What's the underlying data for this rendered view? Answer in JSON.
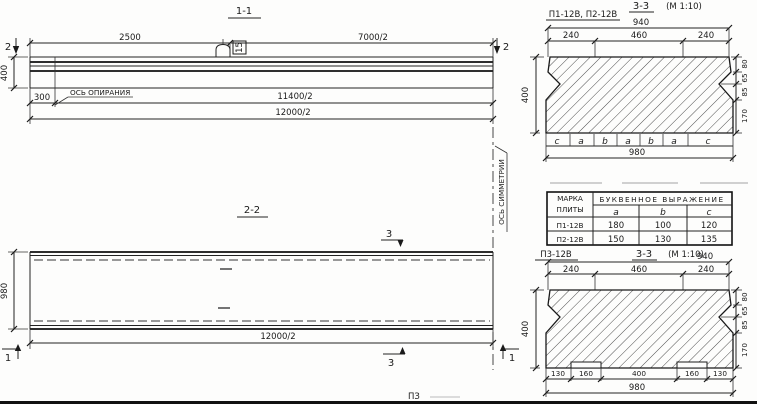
{
  "meta": {
    "ink": "#1f1f1f",
    "paper": "#fdfdfc"
  },
  "s11": {
    "title": "1-1",
    "dim_2500": "2500",
    "dim_7000": "7000/2",
    "marker2_left": "2",
    "marker2_right": "2",
    "dim_400": "400",
    "dim_300": "300",
    "support_axis_label": "ОСЬ ОПИРАНИЯ",
    "hook_tag": "15",
    "dim_11400": "11400/2",
    "dim_12000": "12000/2"
  },
  "s22": {
    "title": "2-2",
    "dim_980": "980",
    "dim_12000": "12000/2",
    "marker3_top": "3",
    "marker3_bottom": "3",
    "marker1_left": "1",
    "marker1_right": "1",
    "symmetry_axis_label": "ОСЬ СИММЕТРИИ"
  },
  "s33a": {
    "label": "П1-12В, П2-12В",
    "title": "3-3",
    "scale": "(М 1:10)",
    "dim_top": "940",
    "dim_seg1": "240",
    "dim_seg2": "460",
    "dim_seg3": "240",
    "dim_height": "400",
    "dim_r1": "80",
    "dim_r2": "65",
    "dim_r3": "85",
    "dim_r4": "170",
    "letters": [
      "c",
      "a",
      "b",
      "a",
      "b",
      "a",
      "c"
    ],
    "dim_bottom": "980"
  },
  "table": {
    "header_col1_line1": "МАРКА",
    "header_col1_line2": "ПЛИТЫ",
    "header_span": "БУКВЕННОЕ ВЫРАЖЕНИЕ",
    "col_a": "a",
    "col_b": "b",
    "col_c": "c",
    "rows": [
      {
        "mark": "П1-12В",
        "a": "180",
        "b": "100",
        "c": "120"
      },
      {
        "mark": "П2-12В",
        "a": "150",
        "b": "130",
        "c": "135"
      }
    ]
  },
  "s33b": {
    "label": "П3-12В",
    "title": "3-3",
    "scale": "(М 1:10)",
    "dim_top": "940",
    "dim_seg1": "240",
    "dim_seg2": "460",
    "dim_seg3": "240",
    "dim_height": "400",
    "dim_r1": "80",
    "dim_r2": "65",
    "dim_r3": "85",
    "dim_r4": "170",
    "dim_b1": "130",
    "dim_b2": "160",
    "dim_b3": "400",
    "dim_b4": "160",
    "dim_b5": "130",
    "dim_bottom": "980"
  },
  "artifact": "ПЗ"
}
